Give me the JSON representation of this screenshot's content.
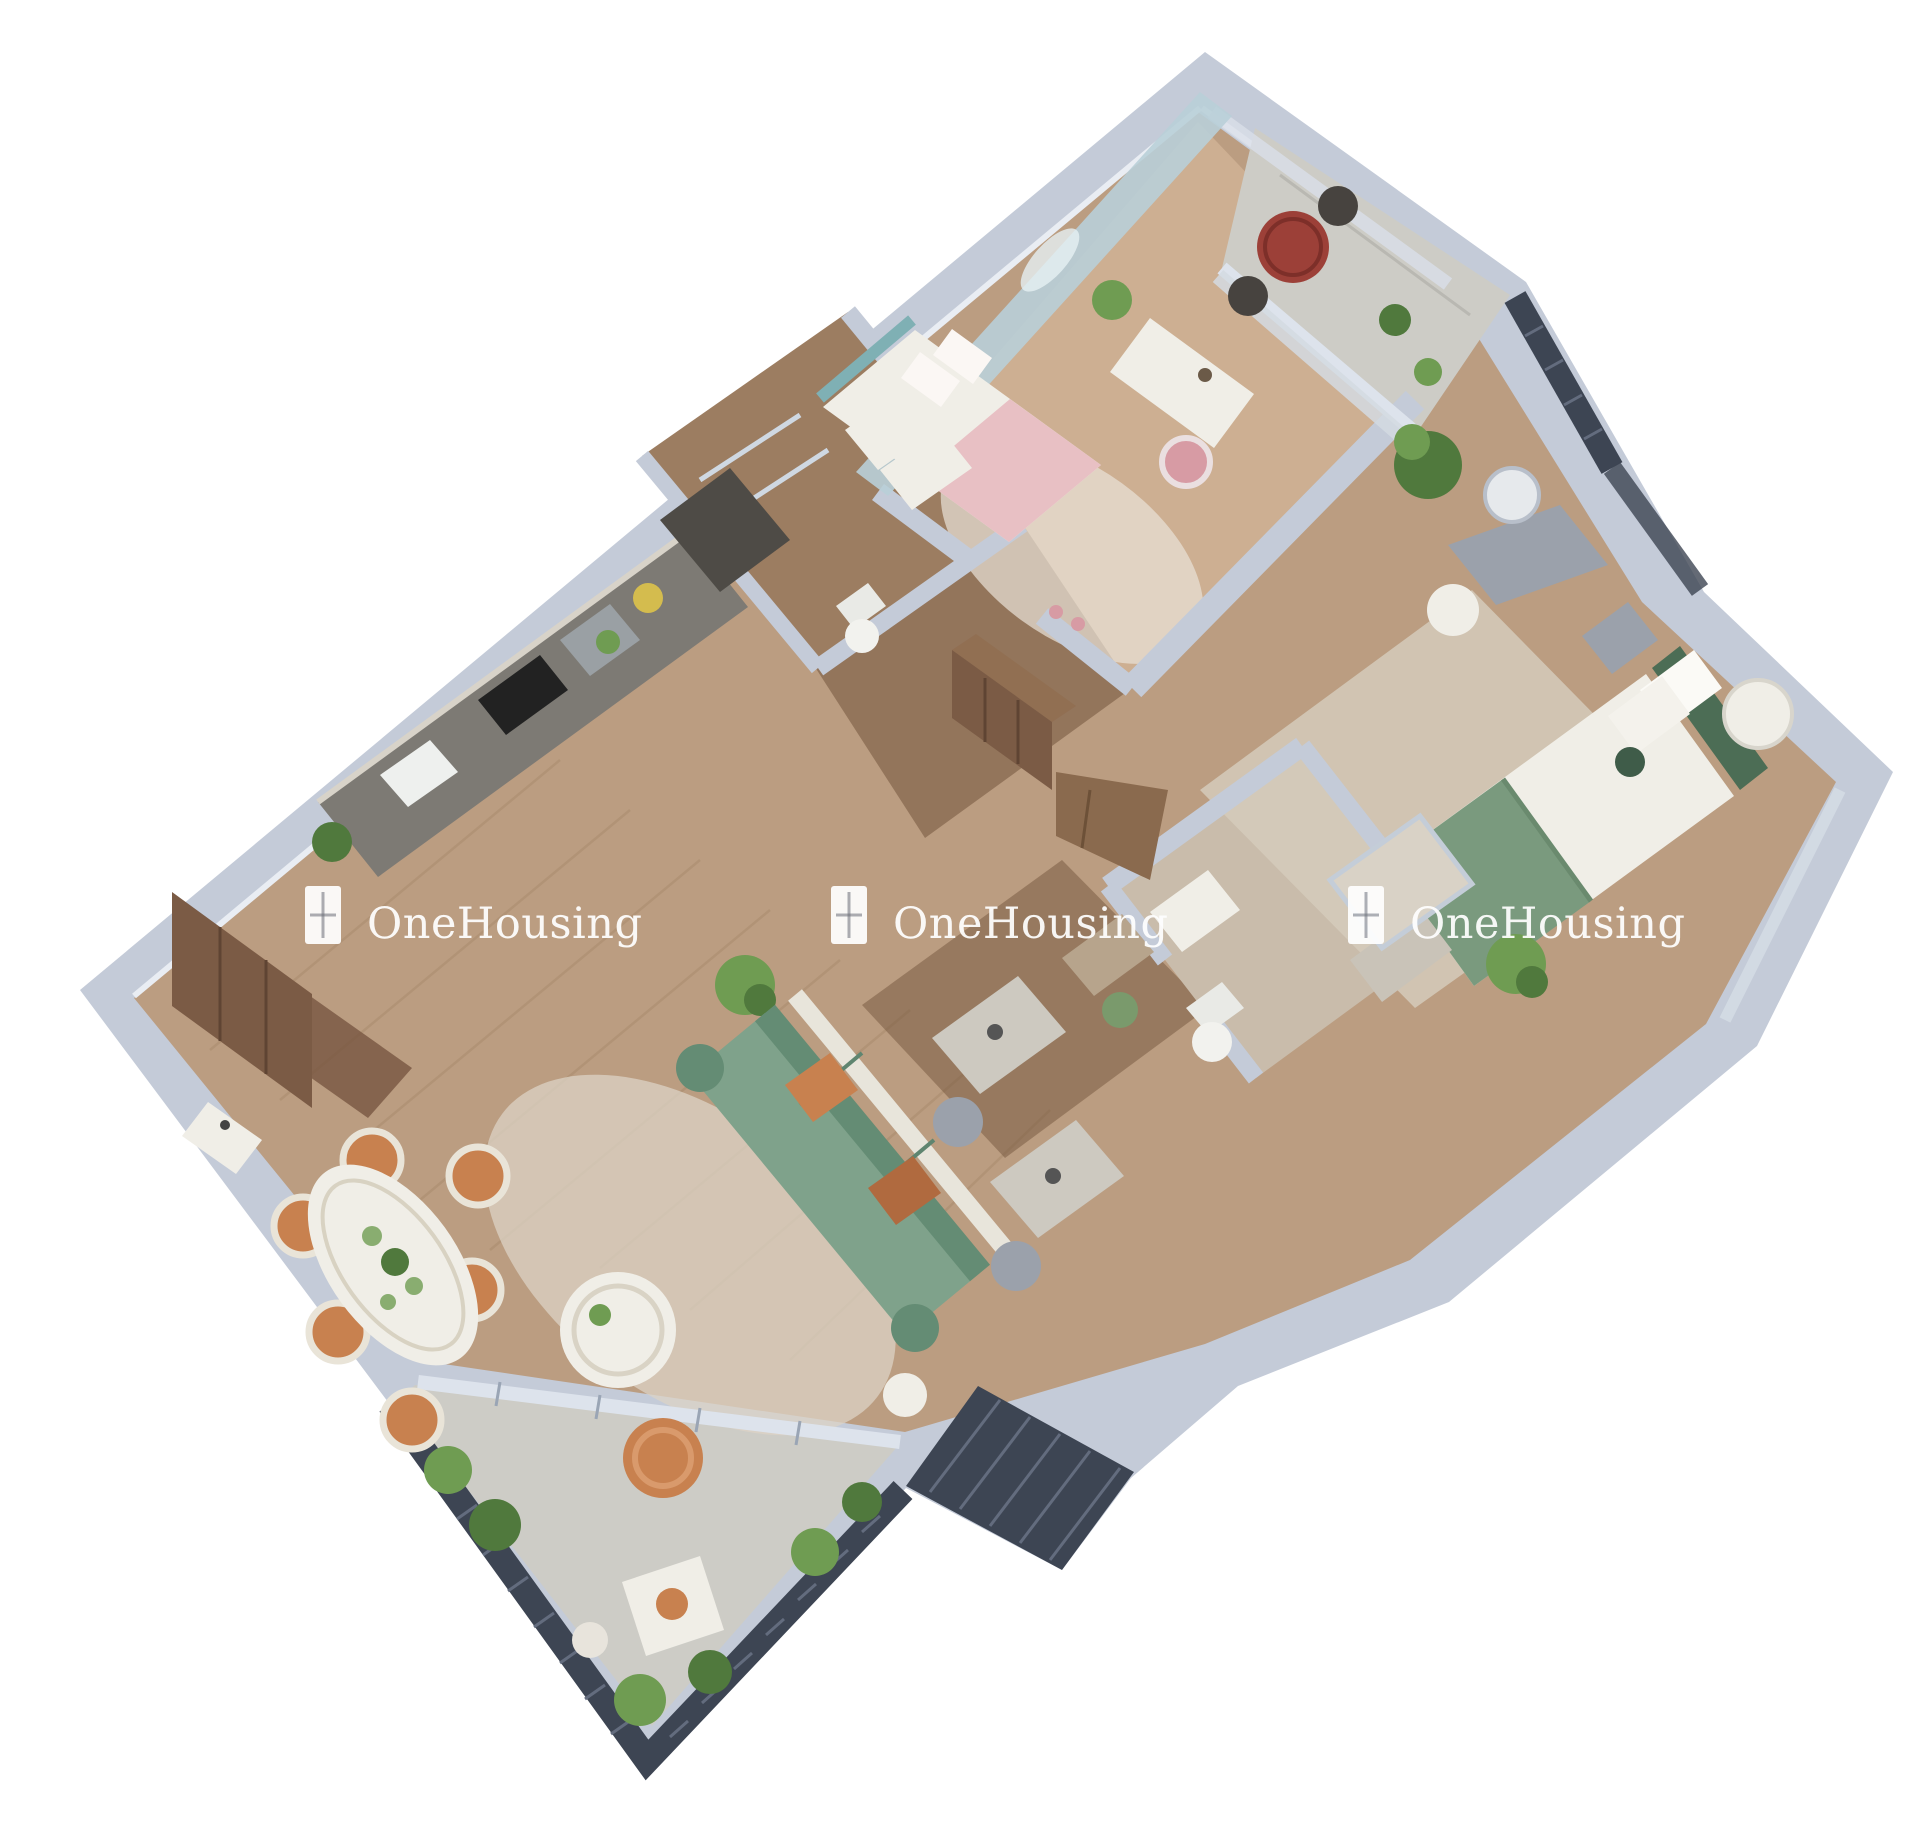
{
  "meta": {
    "description": "3D isometric cutaway floor plan render of a two-bedroom apartment, viewed from above at an angle on a white background",
    "rooms_depicted": [
      "kids-bedroom",
      "balcony-top",
      "bathroom-1",
      "kitchen",
      "entrance",
      "dining-area",
      "living-room",
      "study-nook",
      "master-bedroom",
      "bathroom-2",
      "balcony-bottom",
      "ac-ledge"
    ]
  },
  "watermark": {
    "text": "OneHousing",
    "icon": "window-logo-icon",
    "repetitions": 3,
    "color": "#ffffff"
  },
  "colors": {
    "bg": "#ffffff",
    "wall_face": "#c4cbd8",
    "wall_top": "#e9edf3",
    "wall_deep": "#aeb7c6",
    "wood": "#bb9d81",
    "wood_dark": "#93755b",
    "wood_kids": "#cdaf92",
    "tile_balcony": "#cdccc6",
    "bath1_floor": "#9c7d61",
    "bath2_floor": "#c9bcab",
    "rug": "#dcd3c5",
    "rug2": "#d5cbbb",
    "sofa": "#7fa28b",
    "sofa_dark": "#648c74",
    "pink": "#e8c0c4",
    "pink_dark": "#d79ba4",
    "green_bed": "#7a9a7e",
    "green_head": "#4c6d55",
    "orange": "#c8814f",
    "orange_dark": "#b06a3f",
    "mural": "#b9cfd8",
    "louver": "#3d4553",
    "louver_line": "#636c7e",
    "door_brown": "#7b5b45",
    "door_brown2": "#916f52",
    "counter": "#7d7a74",
    "counter_dark": "#4e4b46",
    "white_furn": "#f0eee7",
    "gray_furn": "#9ba1ab",
    "plant": "#6f9c52",
    "plant_dark": "#50793d",
    "glass": "#dde3ec",
    "watermark": "#ffffff"
  }
}
